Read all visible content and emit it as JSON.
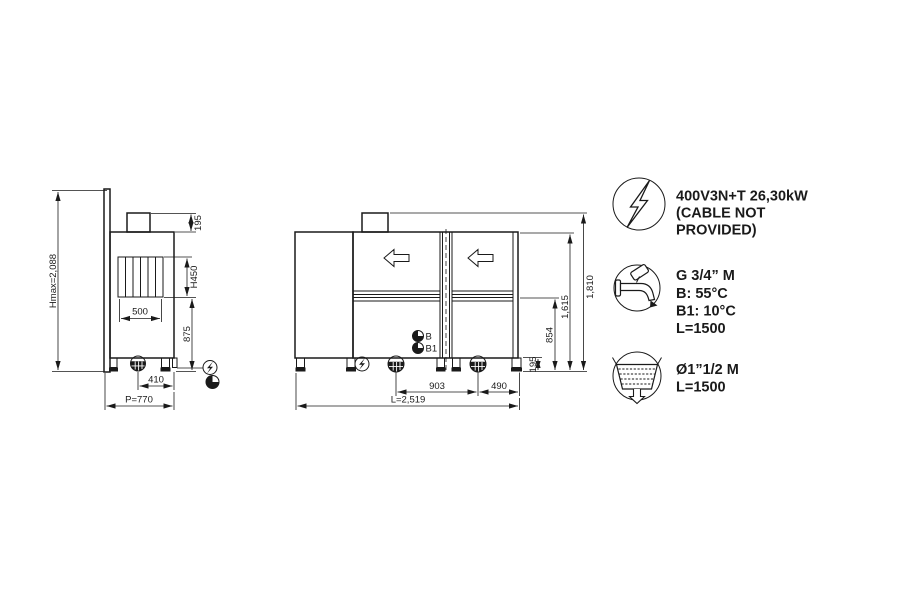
{
  "colors": {
    "line": "#1a1a1a",
    "background": "#ffffff"
  },
  "side_view": {
    "hmax_label": "Hmax=2,088",
    "chimney_height": "195",
    "opening_height": "H450",
    "opening_width": "500",
    "lower_section_height": "875",
    "drain_offset": "410",
    "depth_label": "P=770"
  },
  "front_view": {
    "overall_height": "1,810",
    "body_height": "1,615",
    "worktop_height": "854",
    "leg_height": "195",
    "drain_spacing": "903",
    "drain_to_edge": "490",
    "length_label": "L=2,519",
    "inlet_b": "B",
    "inlet_b1": "B1"
  },
  "legend": {
    "electric": {
      "icon": "lightning-bolt-icon",
      "line1": "400V3N+T 26,30kW",
      "line2": "(CABLE NOT",
      "line3": "PROVIDED)"
    },
    "water_inlet": {
      "icon": "water-tap-icon",
      "line1": "G 3/4” M",
      "line2": "B: 55°C",
      "line3": "B1: 10°C",
      "line4": "L=1500"
    },
    "drain": {
      "icon": "drain-basin-icon",
      "line1": "Ø1”1/2 M",
      "line2": "L=1500"
    }
  }
}
